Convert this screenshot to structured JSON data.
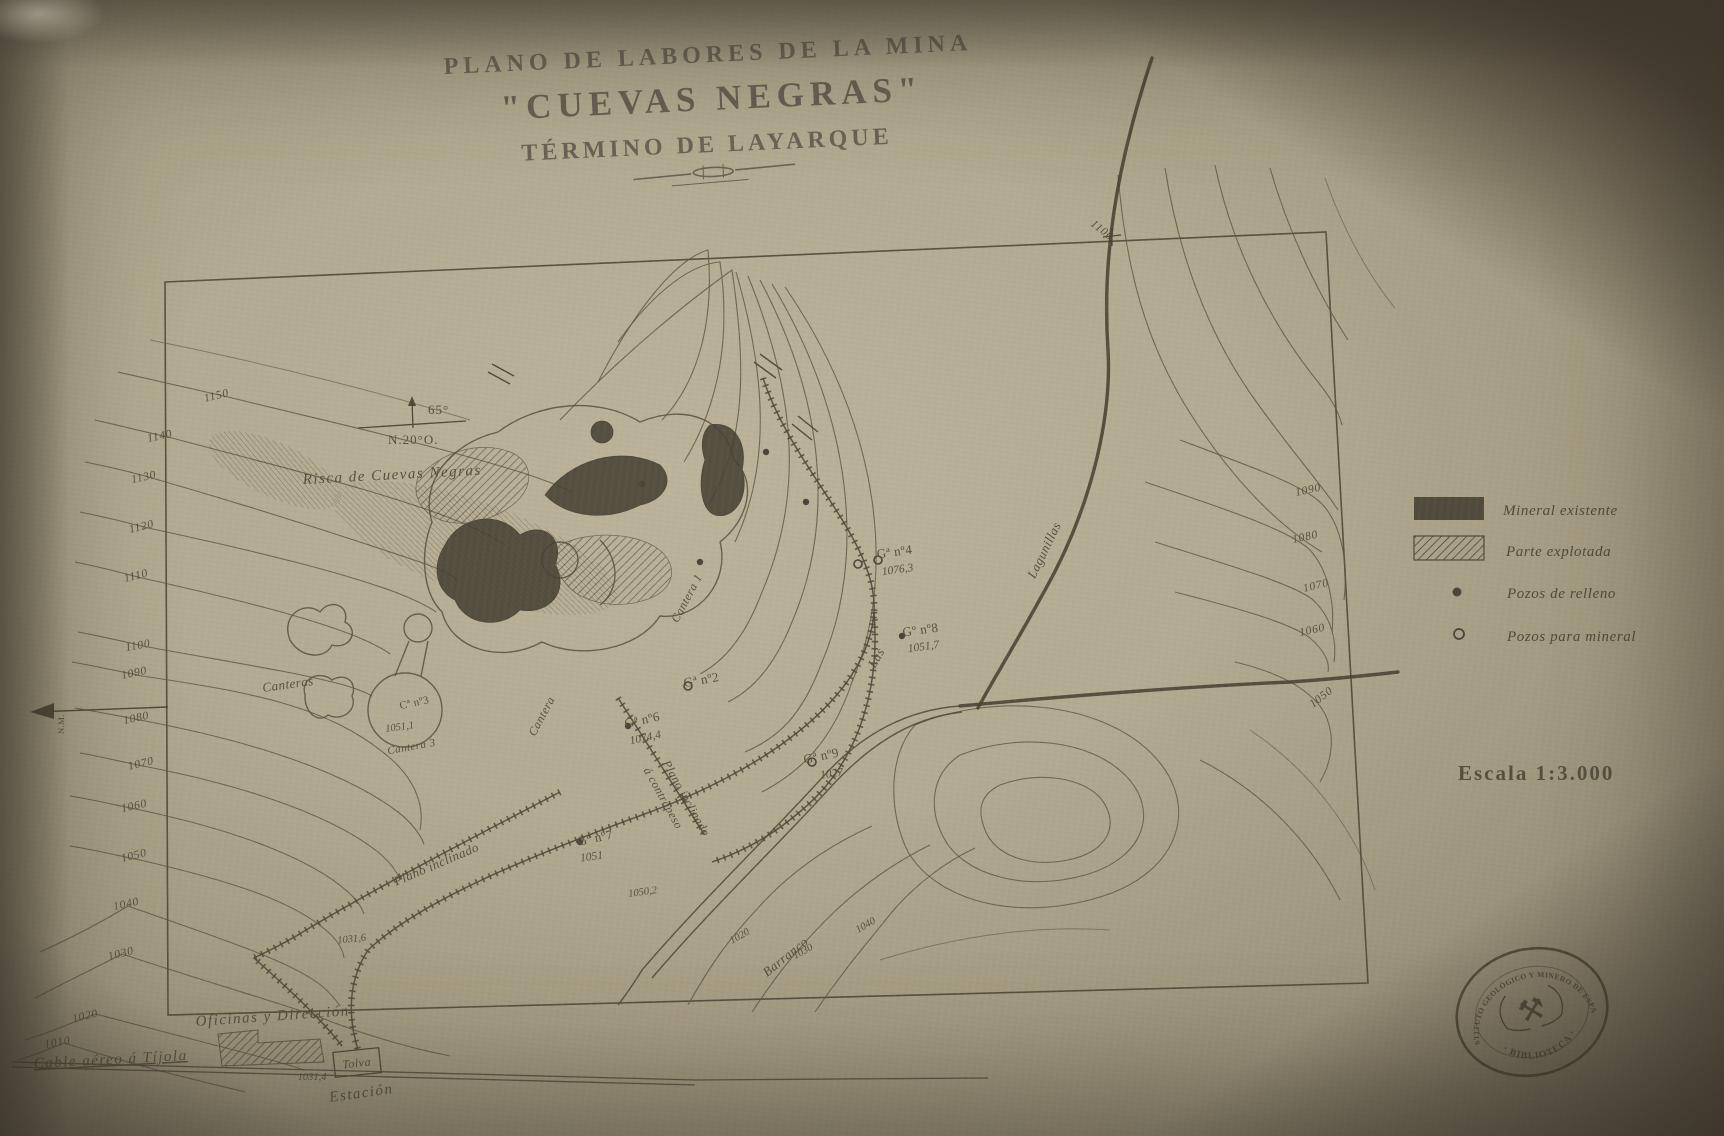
{
  "title": {
    "line1": "PLANO DE LABORES DE LA MINA",
    "line2": "\"CUEVAS NEGRAS\"",
    "line3": "TÉRMINO DE LAYARQUE"
  },
  "compass": {
    "bearing": "65°",
    "declination": "N.20°O.",
    "magnetic_north": "N.M."
  },
  "legend": {
    "mineral_existente": "Mineral existente",
    "parte_explotada": "Parte explotada",
    "pozos_relleno": "Pozos de relleno",
    "pozos_mineral": "Pozos para mineral"
  },
  "scale": {
    "label": "Escala 1:3.000"
  },
  "stamp": {
    "arc_text": "INSTITUTO GEOLÓGICO Y MINERO DE ESPAÑA",
    "bottom_text": "· BIBLIOTECA ·",
    "icon": "⚒"
  },
  "labels": {
    "risca": "Risca de Cuevas Negras",
    "canteras": "Canteras",
    "cantera": "Cantera",
    "cantera1": "Cantera 1",
    "c3_name": "Cª nº3",
    "c3_elev": "1051,1",
    "cantera3": "Cantera 3",
    "g2": "Gª nº2",
    "g4": "Gª nº4",
    "g4_elev": "1076,3",
    "g6": "Gª nº6",
    "g6_elev": "1074,4",
    "g7": "Gª nº7",
    "g7_elev": "1051",
    "g8": "Gº nº8",
    "g8_elev": "1051,7",
    "g9": "Gª nº9",
    "g9_elev": "1027",
    "spot_1050_2": "1050,2",
    "spot_1031_4": "1031,4",
    "spot_1031_6": "1031,6",
    "plano_inclinado_1": "Plano inclinado",
    "plano_inclinado_2": "á contrapeso",
    "plano_inclinado_3": "Plano inclinado",
    "barranco": "Barranco",
    "las": "Las",
    "lagunillas": "Lagunillas",
    "oficinas": "Oficinas y Dirección",
    "tolva": "Tolva",
    "estacion": "Estación",
    "cable": "Cable aéreo á Tíjola"
  },
  "contours": {
    "left": [
      "1150",
      "1140",
      "1130",
      "1120",
      "1110",
      "1100",
      "1090",
      "1080",
      "1070",
      "1060",
      "1050",
      "1040",
      "1030",
      "1020",
      "1010"
    ],
    "right": [
      "1090",
      "1080",
      "1070",
      "1060",
      "1050"
    ],
    "top": "1100",
    "bottom": [
      "1020",
      "1030",
      "1040"
    ]
  }
}
